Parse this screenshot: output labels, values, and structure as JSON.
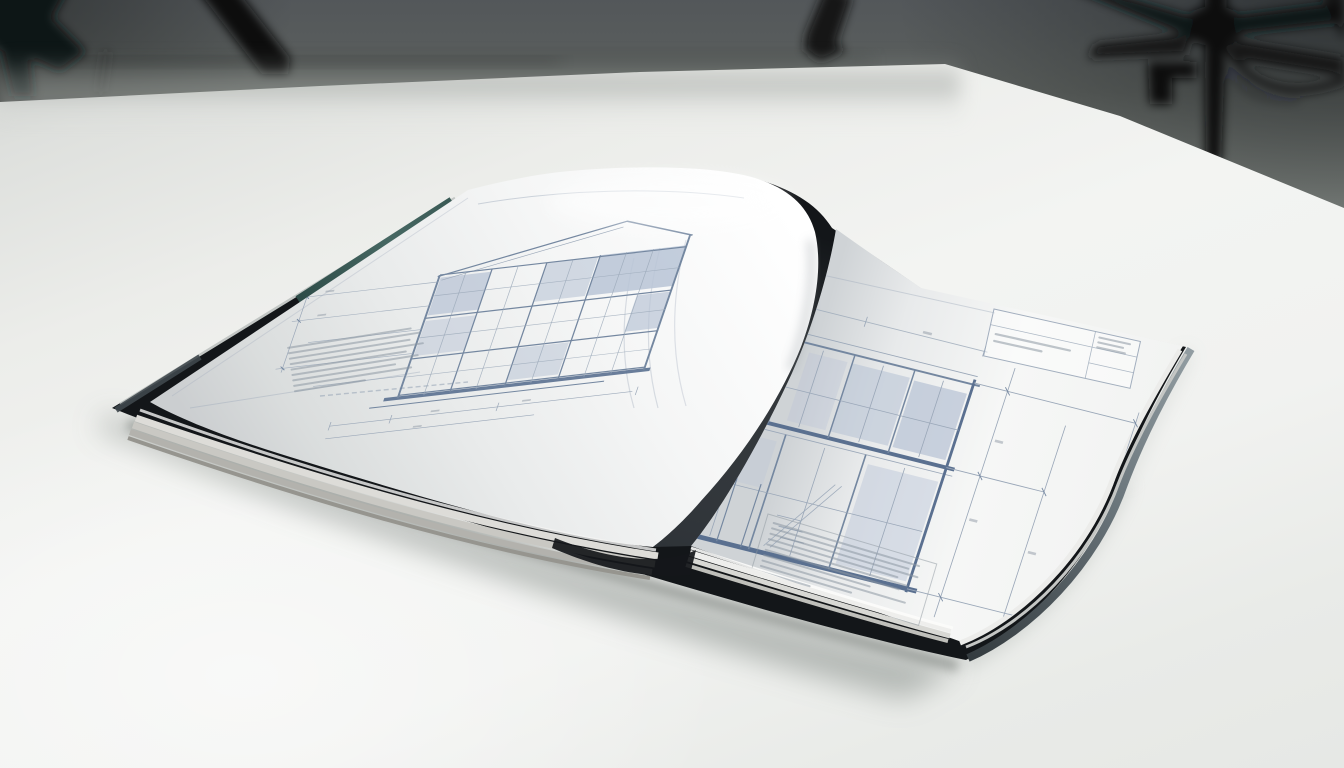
{
  "scene": {
    "description": "Open hardcover book of architectural blueprint elevation drawings lying on a white studio table, photographed with shallow depth of field; blurred black tripod legs and a cable stand in the dark gray background",
    "surface": "white seamless studio table",
    "background": "dark gray studio wall and floor, out of focus"
  },
  "equipment": {
    "left_item": "tripod legs out of focus at top left",
    "center_item": "tripod foot tip at top center",
    "right_item": "tripod column with spread legs, clamp bracket and trailing cable at top right"
  },
  "book": {
    "type": "hardcover monograph, open at double-page spread",
    "cover_color_name": "black with teal accent band on fore-edge",
    "left_page": {
      "drawing": "facade elevation with gable roof and grid of shaded window panels",
      "annotations": "blurred specification text block and dimension lines, illegible"
    },
    "right_page": {
      "drawing": "two-storey elevation with heavy floor bands, stair detail and dimension chains",
      "annotations": "blurred title block at top right and notes block at bottom, illegible"
    }
  },
  "palette": {
    "bg_top": "#53575a",
    "bg_mid": "#9aa09b",
    "table": "#eef0ed",
    "table_hi": "#f5f6f4",
    "shadow": "#a6aba7",
    "cover": "#131619",
    "teal": "#3a5a55",
    "page": "#f7f8f7",
    "line_light": "#9aa7b8",
    "line_mid": "#7487a0",
    "line_heavy": "#5a7090",
    "panel": "#b9c4d6",
    "text_line": "#8d97a3",
    "stack1": "#dddcd8",
    "stack2": "#c9c8c3",
    "stack3": "#b3b2ad",
    "stack4": "#96958f"
  },
  "blocks": {
    "left_notes": [
      90,
      96,
      88,
      97,
      84,
      92,
      75,
      86,
      52
    ],
    "right_notes": [
      96,
      90,
      97,
      85,
      92,
      88,
      70,
      94,
      60,
      34
    ],
    "title_left": [
      85,
      55
    ],
    "title_right": [
      88,
      72,
      80
    ]
  }
}
